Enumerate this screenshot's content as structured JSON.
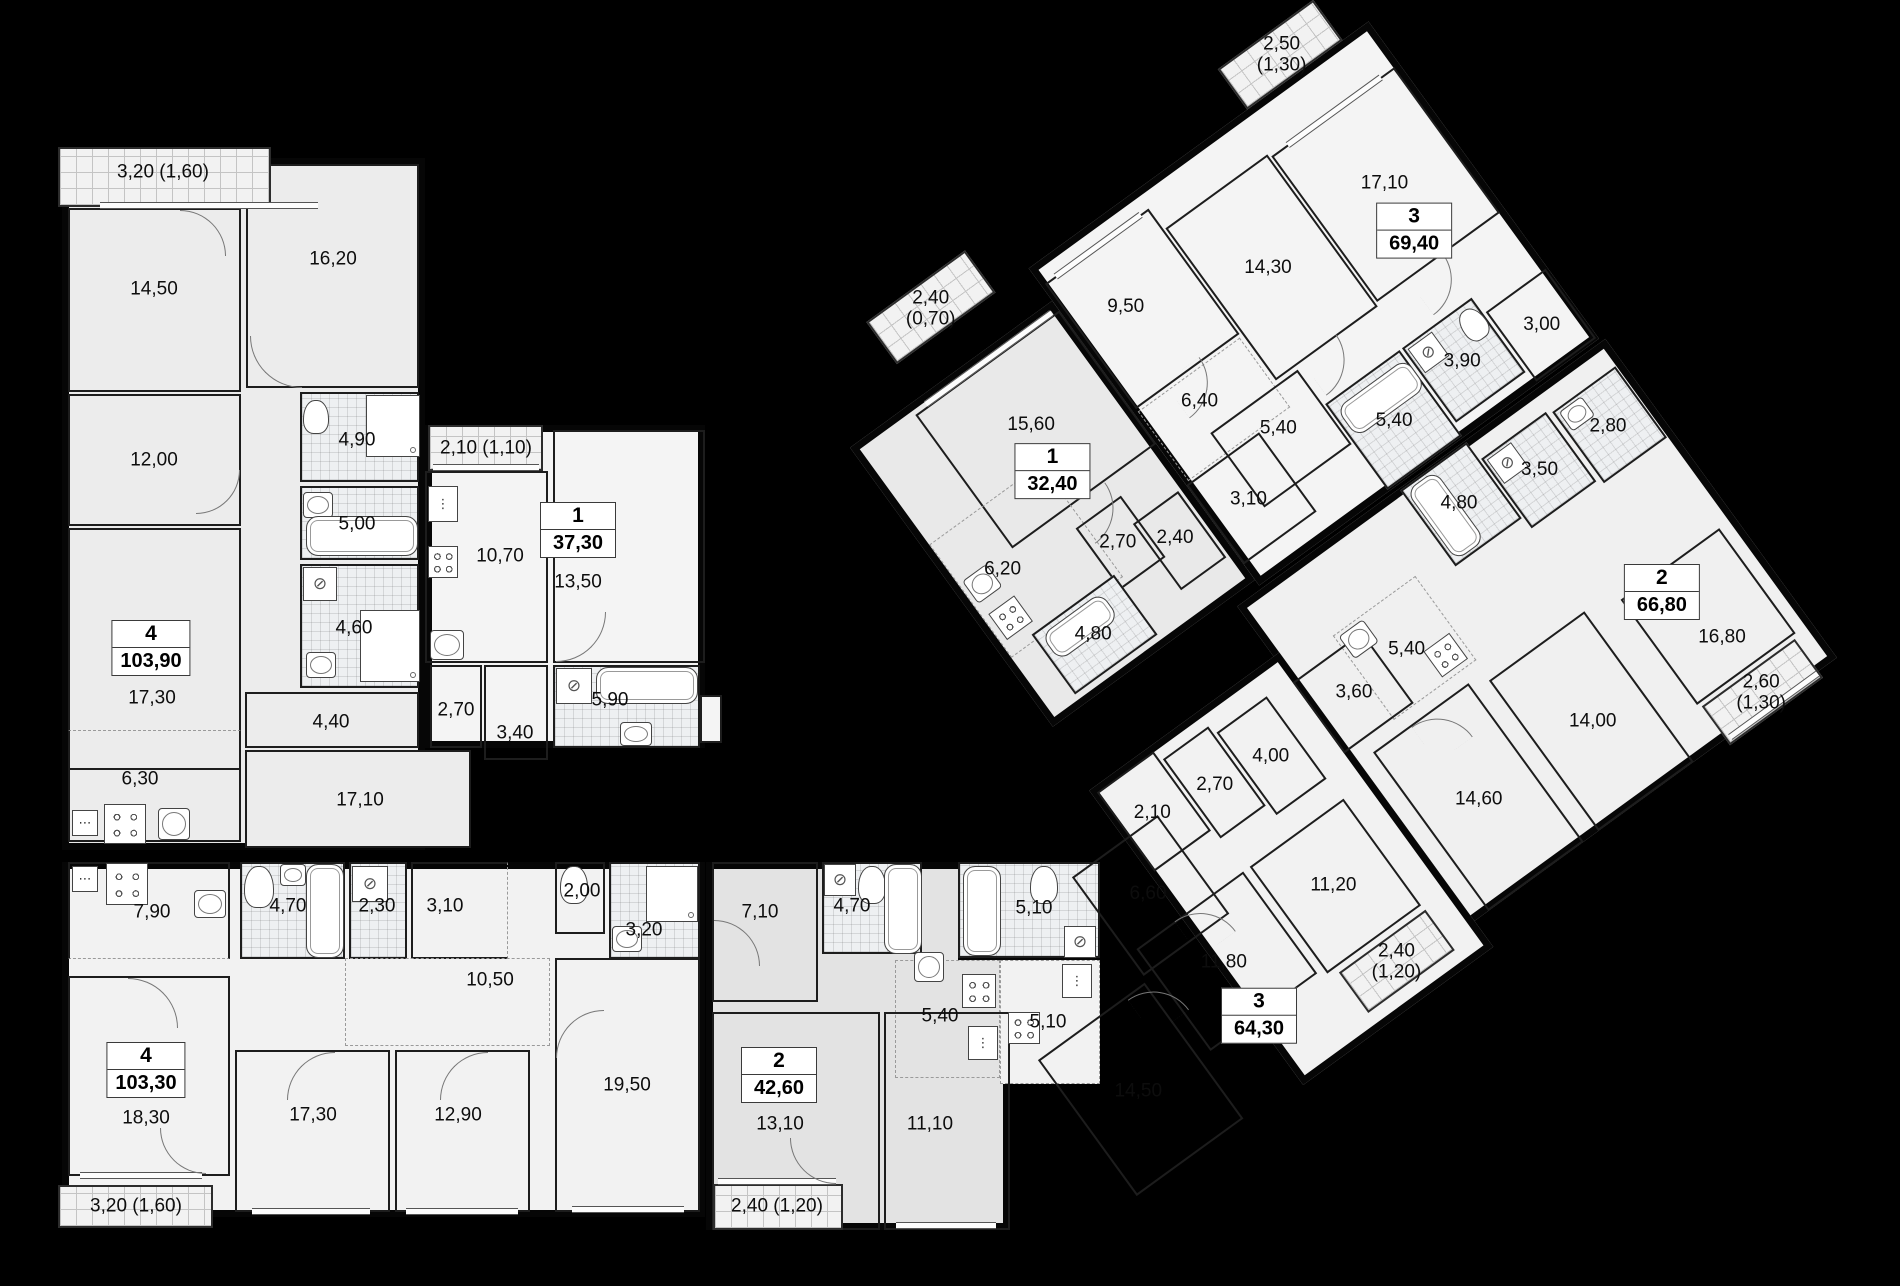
{
  "canvas": {
    "width": 1900,
    "height": 1286,
    "background_color": "#000000",
    "wall_color": "#141414",
    "floor_light_color": "#f3f3f3",
    "floor_grey_color": "#e5e5e5",
    "bath_tile_color": "#eef0f2"
  },
  "apartments": [
    {
      "id": "apt-4-103-90",
      "badge": {
        "rooms": "4",
        "area": "103,90"
      },
      "areas": [
        {
          "key": "balcony",
          "label": "3,20 (1,60)"
        },
        {
          "key": "room-14-50",
          "label": "14,50"
        },
        {
          "key": "room-16-20",
          "label": "16,20"
        },
        {
          "key": "room-12-00",
          "label": "12,00"
        },
        {
          "key": "bath-4-90",
          "label": "4,90"
        },
        {
          "key": "bath-5-00",
          "label": "5,00"
        },
        {
          "key": "bath-4-60",
          "label": "4,60"
        },
        {
          "key": "room-17-30",
          "label": "17,30"
        },
        {
          "key": "hall-4-40",
          "label": "4,40"
        },
        {
          "key": "kitchen-6-30",
          "label": "6,30"
        },
        {
          "key": "hall-17-10",
          "label": "17,10"
        }
      ]
    },
    {
      "id": "apt-1-37-30",
      "badge": {
        "rooms": "1",
        "area": "37,30"
      },
      "areas": [
        {
          "key": "balcony",
          "label": "2,10 (1,10)"
        },
        {
          "key": "kitchen-10-70",
          "label": "10,70"
        },
        {
          "key": "room-13-50",
          "label": "13,50"
        },
        {
          "key": "hall-2-70",
          "label": "2,70"
        },
        {
          "key": "hall-3-40",
          "label": "3,40"
        },
        {
          "key": "bath-5-90",
          "label": "5,90"
        }
      ]
    },
    {
      "id": "apt-4-103-30",
      "badge": {
        "rooms": "4",
        "area": "103,30"
      },
      "areas": [
        {
          "key": "balcony",
          "label": "3,20 (1,60)"
        },
        {
          "key": "kitchen-7-90",
          "label": "7,90"
        },
        {
          "key": "bath-4-70",
          "label": "4,70"
        },
        {
          "key": "wc-2-30",
          "label": "2,30"
        },
        {
          "key": "hall-3-10",
          "label": "3,10"
        },
        {
          "key": "wc-2-00",
          "label": "2,00"
        },
        {
          "key": "bath-3-20",
          "label": "3,20"
        },
        {
          "key": "hall-10-50",
          "label": "10,50"
        },
        {
          "key": "room-18-30",
          "label": "18,30"
        },
        {
          "key": "room-17-30",
          "label": "17,30"
        },
        {
          "key": "room-12-90",
          "label": "12,90"
        },
        {
          "key": "room-19-50",
          "label": "19,50"
        }
      ]
    },
    {
      "id": "apt-2-42-60",
      "badge": {
        "rooms": "2",
        "area": "42,60"
      },
      "areas": [
        {
          "key": "balcony",
          "label": "2,40 (1,20)"
        },
        {
          "key": "hall-7-10",
          "label": "7,10"
        },
        {
          "key": "bath-4-70",
          "label": "4,70"
        },
        {
          "key": "kitchen-5-40",
          "label": "5,40"
        },
        {
          "key": "room-13-10",
          "label": "13,10"
        },
        {
          "key": "room-11-10",
          "label": "11,10"
        }
      ]
    },
    {
      "id": "apt-1-32-40",
      "badge": {
        "rooms": "1",
        "area": "32,40"
      },
      "areas": [
        {
          "key": "balcony",
          "label": "2,40 (0,70)"
        },
        {
          "key": "room-15-60",
          "label": "15,60"
        },
        {
          "key": "kitchen-6-20",
          "label": "6,20"
        },
        {
          "key": "hall-2-70",
          "label": "2,70"
        },
        {
          "key": "hall-2-40",
          "label": "2,40"
        },
        {
          "key": "bath-4-80",
          "label": "4,80"
        }
      ]
    },
    {
      "id": "apt-3-69-40",
      "badge": {
        "rooms": "3",
        "area": "69,40"
      },
      "areas": [
        {
          "key": "balcony",
          "label": "2,50 (1,30)"
        },
        {
          "key": "room-17-10",
          "label": "17,10"
        },
        {
          "key": "room-14-30",
          "label": "14,30"
        },
        {
          "key": "kitchen-9-50",
          "label": "9,50"
        },
        {
          "key": "hall-6-40",
          "label": "6,40"
        },
        {
          "key": "hall-5-40",
          "label": "5,40"
        },
        {
          "key": "hall-3-10",
          "label": "3,10"
        },
        {
          "key": "bath-5-40",
          "label": "5,40"
        },
        {
          "key": "bath-3-90",
          "label": "3,90"
        },
        {
          "key": "hall-3-00",
          "label": "3,00"
        }
      ]
    },
    {
      "id": "apt-2-66-80",
      "badge": {
        "rooms": "2",
        "area": "66,80"
      },
      "areas": [
        {
          "key": "balcony",
          "label": "2,60 (1,30)"
        },
        {
          "key": "bath-2-80",
          "label": "2,80"
        },
        {
          "key": "bath-3-50",
          "label": "3,50"
        },
        {
          "key": "bath-4-80",
          "label": "4,80"
        },
        {
          "key": "kitchen-5-40",
          "label": "5,40"
        },
        {
          "key": "hall-3-60",
          "label": "3,60"
        },
        {
          "key": "room-14-60",
          "label": "14,60"
        },
        {
          "key": "room-14-00",
          "label": "14,00"
        },
        {
          "key": "room-16-80",
          "label": "16,80"
        }
      ]
    },
    {
      "id": "apt-3-64-30",
      "badge": {
        "rooms": "3",
        "area": "64,30"
      },
      "areas": [
        {
          "key": "balcony",
          "label": "2,40 (1,20)"
        },
        {
          "key": "hall-2-10",
          "label": "2,10"
        },
        {
          "key": "hall-2-70",
          "label": "2,70"
        },
        {
          "key": "hall-4-00",
          "label": "4,00"
        },
        {
          "key": "bath-5-10",
          "label": "5,10"
        },
        {
          "key": "kitchen-5-10",
          "label": "5,10"
        },
        {
          "key": "hall-6-60",
          "label": "6,60"
        },
        {
          "key": "room-11-80",
          "label": "11,80"
        },
        {
          "key": "room-11-20",
          "label": "11,20"
        },
        {
          "key": "room-14-50",
          "label": "14,50"
        }
      ]
    }
  ]
}
